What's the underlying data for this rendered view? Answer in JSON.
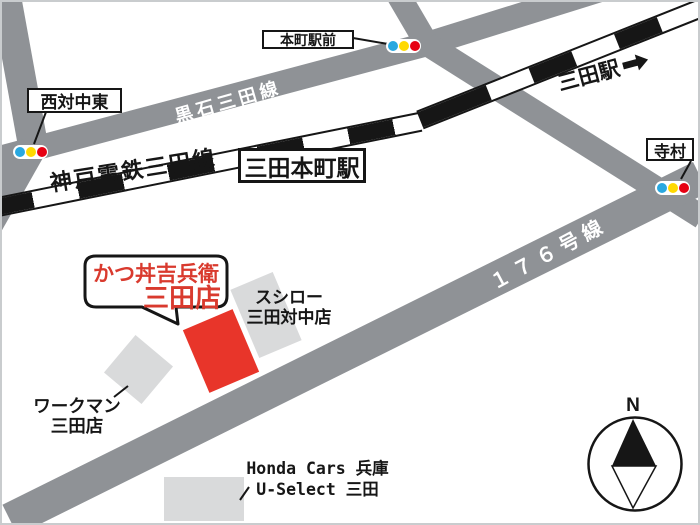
{
  "map": {
    "bubble": {
      "line1": "かつ丼吉兵衛",
      "line2": "三田店"
    },
    "road_labels": {
      "kuroishi_sanda_line": "黒石三田線",
      "route_176": "１７６号線"
    },
    "railway_label": "神戸電鉄三田線",
    "stations": {
      "nishi_tai_naka_higashi": "西対中東",
      "honmachi_ekimae": "本町駅前",
      "sanda_honmachi": "三田本町駅",
      "sanda": "三田駅",
      "teramura": "寺村"
    },
    "places": {
      "sushiro": {
        "line1": "スシロー",
        "line2": "三田対中店"
      },
      "workman": {
        "line1": "ワークマン",
        "line2": "三田店"
      },
      "honda": {
        "line1": "Honda Cars 兵庫",
        "line2": "U-Select 三田"
      }
    },
    "compass": {
      "north": "N"
    },
    "colors": {
      "road_gray": "#8f9296",
      "building_gray": "#d9dadb",
      "highlight_red": "#e8352a",
      "text_red": "#d93a2e",
      "signal_blue": "#29a8e0",
      "signal_yellow": "#ffd900",
      "signal_red": "#e60012",
      "line_black": "#161616"
    }
  }
}
